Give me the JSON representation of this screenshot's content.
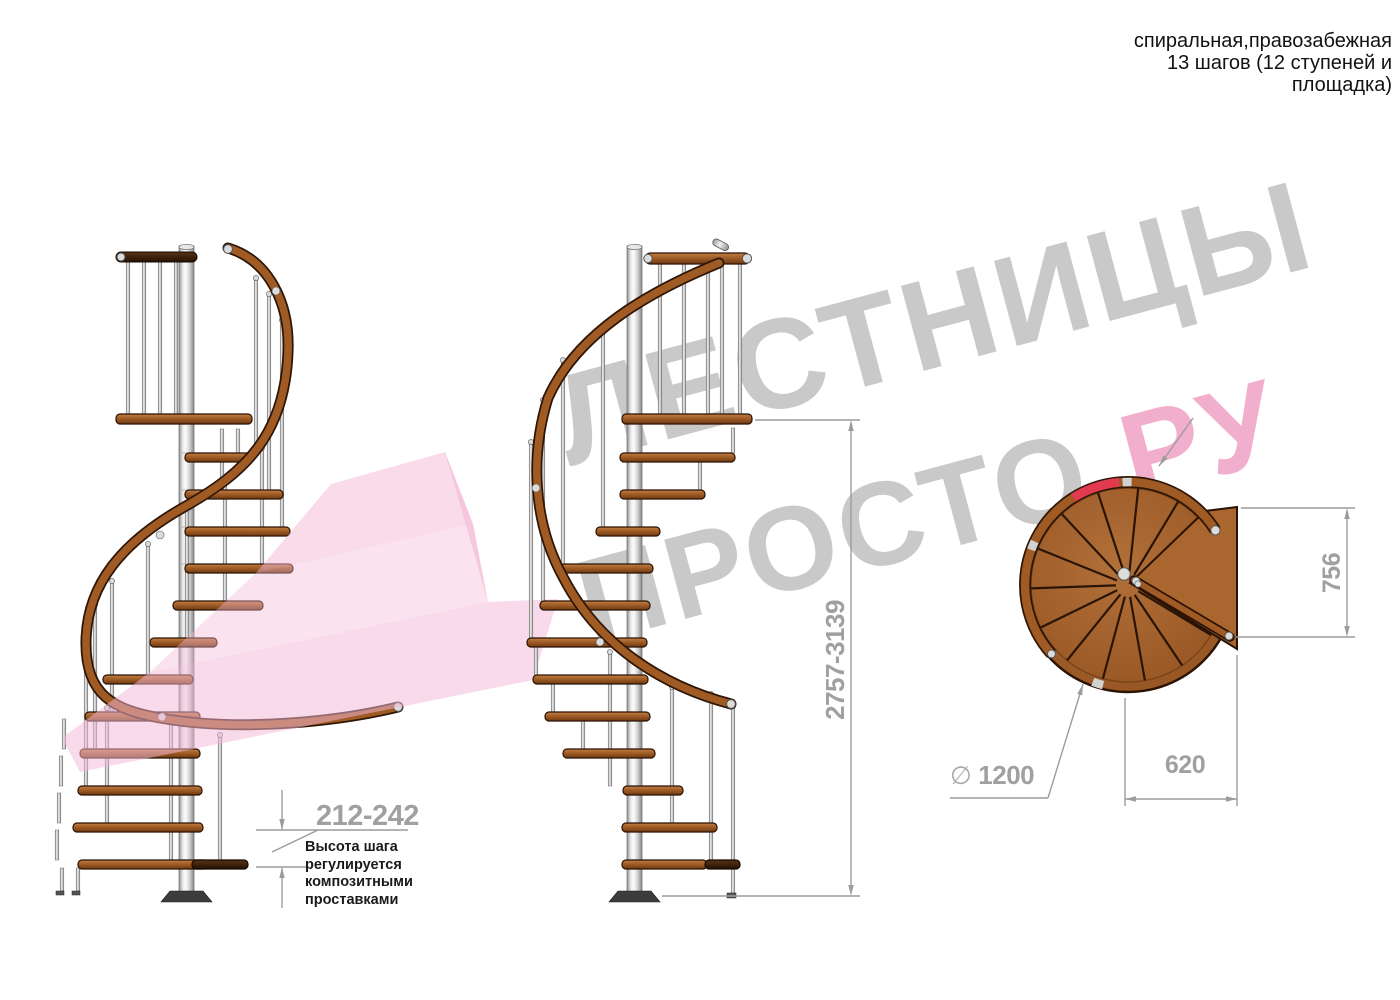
{
  "title_block": {
    "text": "спиральная,правозабежная\n13 шагов (12 ступеней и\nплощадка)"
  },
  "watermark": {
    "line1": "ЛЕСТНИЦЫ",
    "line2_gray": "ПРОСТО",
    "line2_pink": ".РУ"
  },
  "dimensions": {
    "step_height": {
      "value": "212-242",
      "note": "Высота шага\nрегулируется\nкомпозитными\nпроставками"
    },
    "total_height": {
      "value": "2757-3139"
    },
    "plan_depth": {
      "value": "756"
    },
    "plan_width": {
      "value": "620"
    },
    "diameter": {
      "symbol": "∅",
      "value": "1200"
    }
  },
  "colors": {
    "wood": "#a5622a",
    "wood_dark_edge": "#2a1204",
    "rail_wood": "#9c5a26",
    "pole_silver": "#d8d8d8",
    "dimension_gray": "#9c9c9c",
    "watermark_gray": "#c9c9c9",
    "watermark_pink": "#f2afcd",
    "logo_pink": "#f3b8d6",
    "red_marker": "#e23b4f"
  }
}
